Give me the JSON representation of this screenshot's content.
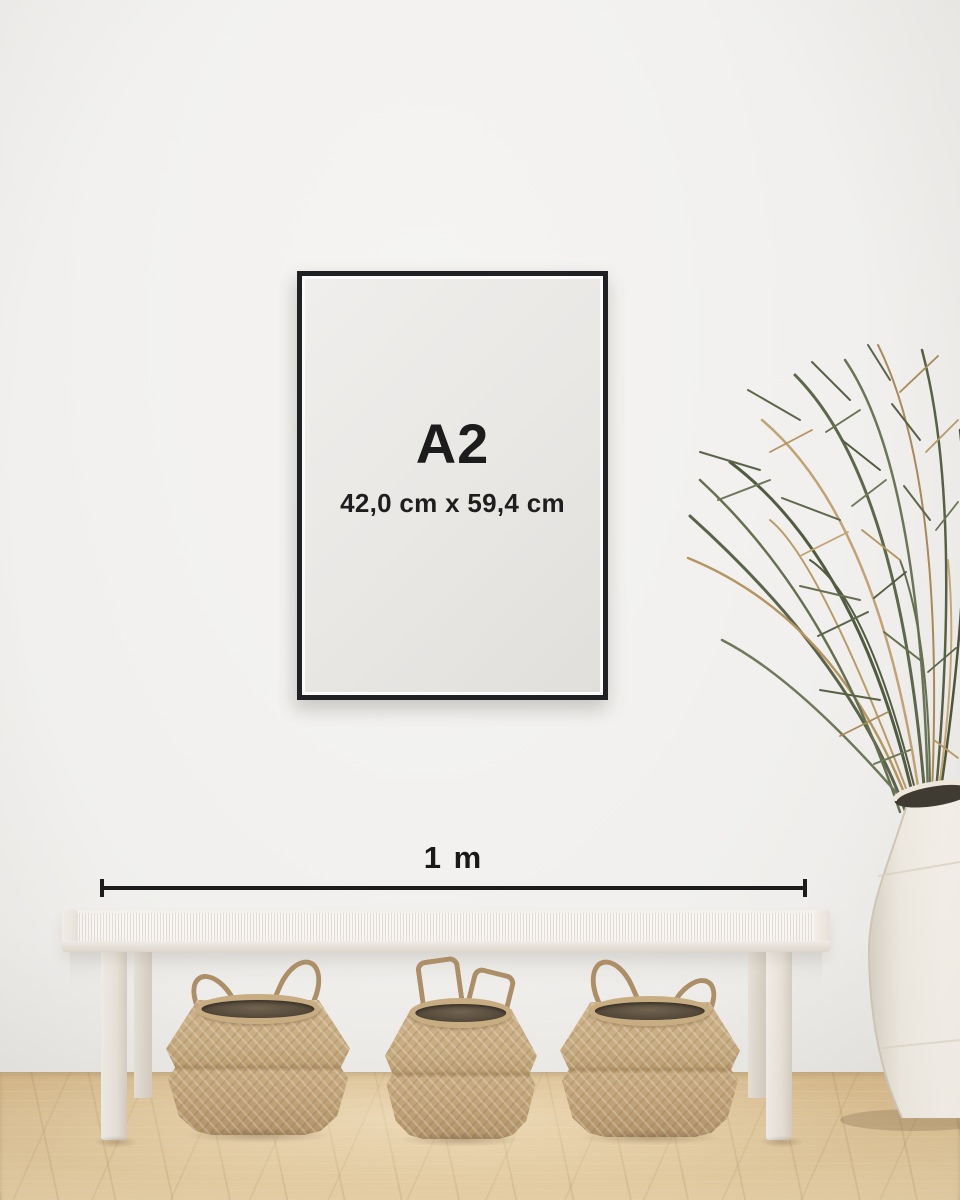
{
  "poster": {
    "size_label": "A2",
    "dimensions_label": "42,0 cm x 59,4 cm"
  },
  "scale_bar": {
    "label": "1 m"
  },
  "scene": {
    "baskets_count": 3,
    "colors": {
      "wall": "#f1f0ee",
      "frame": "#1f2125",
      "poster_paper": "#e9e7e4",
      "text": "#1c1c1c",
      "floor_wood": "#ddc295",
      "bench": "#f3efe9",
      "basket": "#c3a77c",
      "basket_interior": "#574b3c",
      "plant_green": "#5d674b",
      "plant_dried": "#b3925f",
      "vase": "#f2eee7"
    }
  }
}
